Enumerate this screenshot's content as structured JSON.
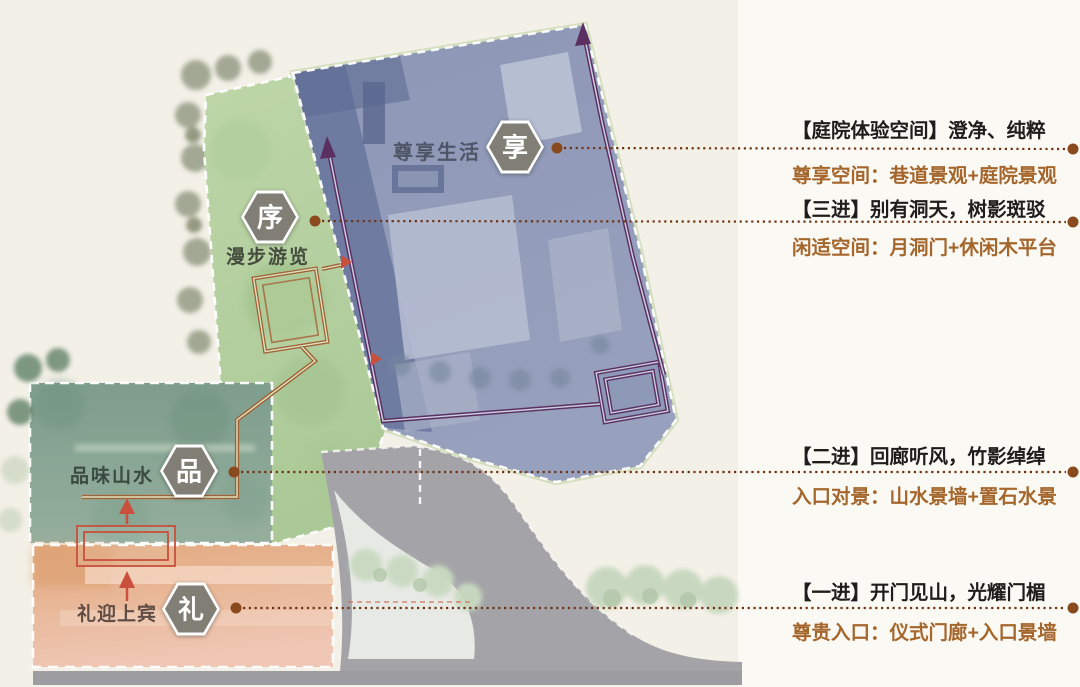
{
  "colors": {
    "background": "#f3f0e7",
    "panel": "#fbf9f4",
    "leader_line_brown": "#6f3312",
    "leader_dot_brown": "#8a4a1e",
    "annotation_title": "#1d1d1d",
    "annotation_subtitle": "#a5662c",
    "badge_gray": "#817e76",
    "route_purple": "#5c2f63",
    "route_orange": "#a26136",
    "arrow_red": "#c8503c",
    "building_blue": "#8f99b7",
    "lawn_green": "#b7d0a2",
    "garden_green": "#8ca797",
    "entry_pink": "#eac0a4",
    "road_gray": "#a4a4a8"
  },
  "map": {
    "zones": [
      {
        "badge": "享",
        "label": "尊享生活"
      },
      {
        "badge": "序",
        "label": "漫步游览"
      },
      {
        "badge": "品",
        "label": "品味山水"
      },
      {
        "badge": "礼",
        "label": "礼迎上宾"
      }
    ]
  },
  "annotations": [
    {
      "title": "【庭院体验空间】澄净、纯粹",
      "subtitle": "尊享空间：巷道景观+庭院景观"
    },
    {
      "title": "【三进】别有洞天，树影斑驳",
      "subtitle": "闲适空间：月洞门+休闲木平台"
    },
    {
      "title": "【二进】回廊听风，竹影绰绰",
      "subtitle": "入口对景：山水景墙+置石水景"
    },
    {
      "title": "【一进】开门见山，光耀门楣",
      "subtitle": "尊贵入口：仪式门廊+入口景墙"
    }
  ]
}
